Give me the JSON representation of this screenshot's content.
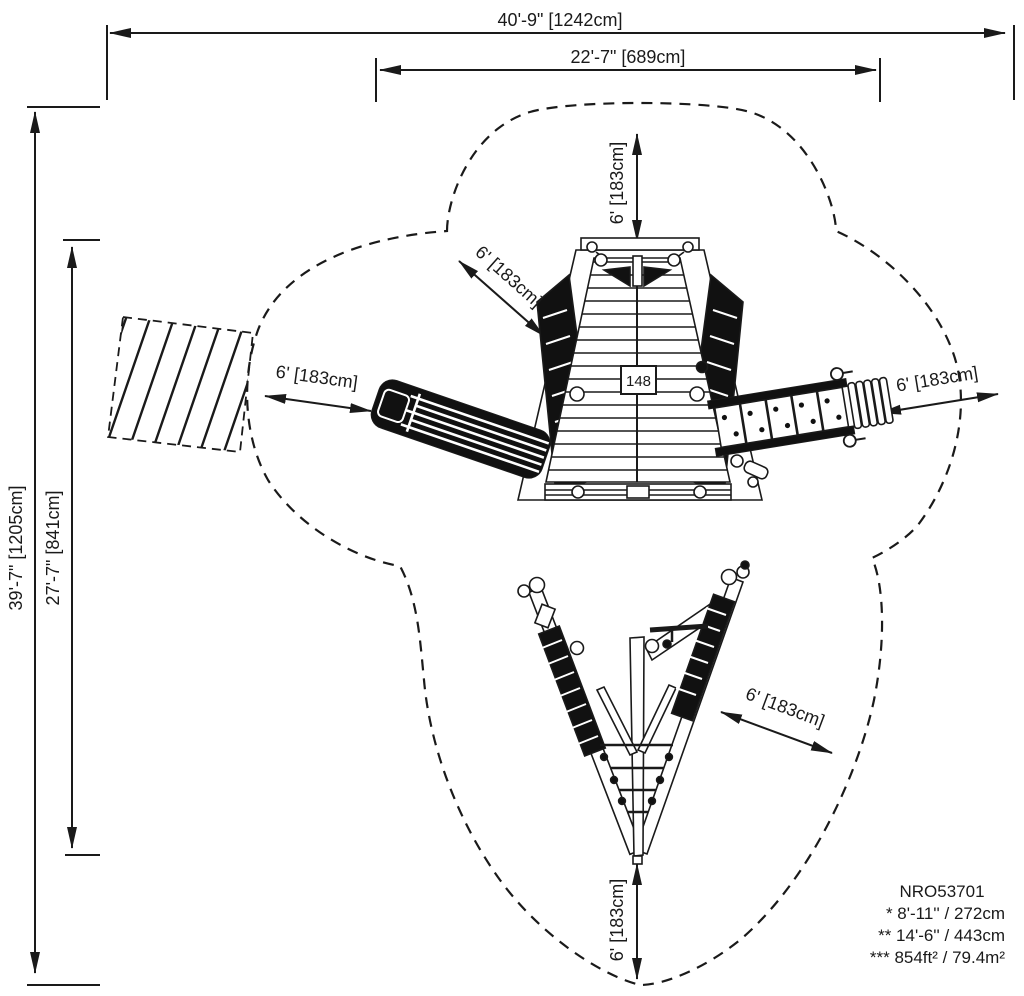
{
  "doc": {
    "model_number": "NRO53701",
    "footnote_1": "* 8'-11'' / 272cm",
    "footnote_2": "** 14'-6'' / 443cm",
    "footnote_3": "*** 854ft² / 79.4m²"
  },
  "dimensions": {
    "overall_width": "40'-9\" [1242cm]",
    "inner_width": "22'-7\" [689cm]",
    "overall_depth": "39'-7\" [1205cm]",
    "inner_depth": "27'-7\" [841cm]"
  },
  "clearances": {
    "top": "6' [183cm]",
    "upper_left": "6' [183cm]",
    "left": "6' [183cm]",
    "right": "6' [183cm]",
    "lower_right": "6' [183cm]",
    "bottom": "6' [183cm]"
  },
  "labels": {
    "deck_tag": "148"
  },
  "colors": {
    "ink": "#1a1a1a",
    "background": "#ffffff"
  }
}
